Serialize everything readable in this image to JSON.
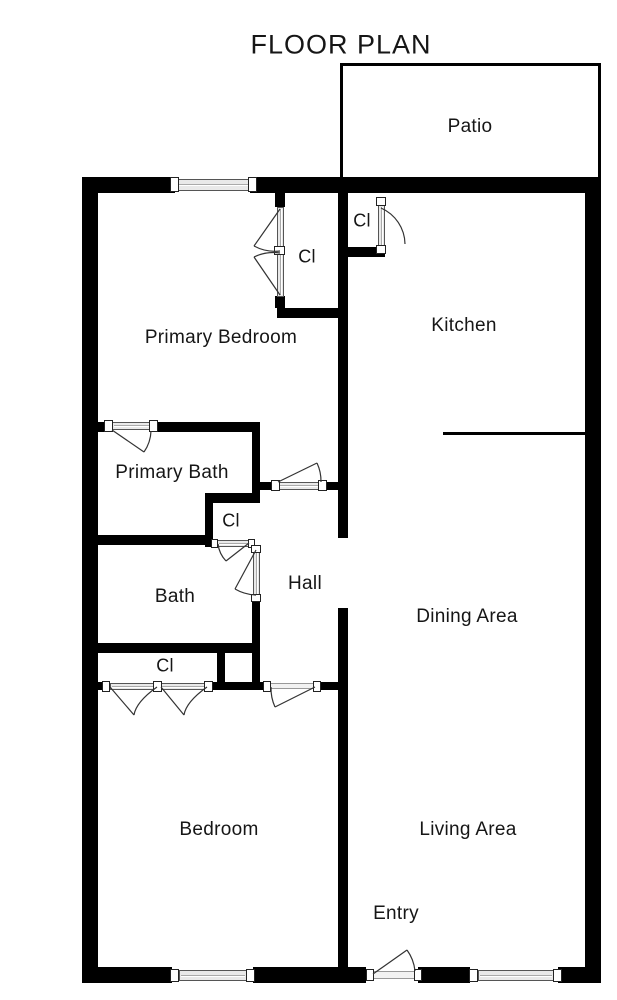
{
  "title": "FLOOR PLAN",
  "colors": {
    "wall": "#000000",
    "background": "#ffffff",
    "text": "#161616"
  },
  "rooms": {
    "patio": {
      "label": "Patio"
    },
    "primary_bedroom": {
      "label": "Primary Bedroom"
    },
    "kitchen": {
      "label": "Kitchen"
    },
    "primary_bath": {
      "label": "Primary Bath"
    },
    "bath": {
      "label": "Bath"
    },
    "hall": {
      "label": "Hall"
    },
    "dining_area": {
      "label": "Dining Area"
    },
    "bedroom": {
      "label": "Bedroom"
    },
    "living_area": {
      "label": "Living Area"
    },
    "entry": {
      "label": "Entry"
    },
    "closet_kitchen": {
      "label": "Cl"
    },
    "closet_primary": {
      "label": "Cl"
    },
    "closet_hall": {
      "label": "Cl"
    },
    "closet_bedroom": {
      "label": "Cl"
    }
  }
}
